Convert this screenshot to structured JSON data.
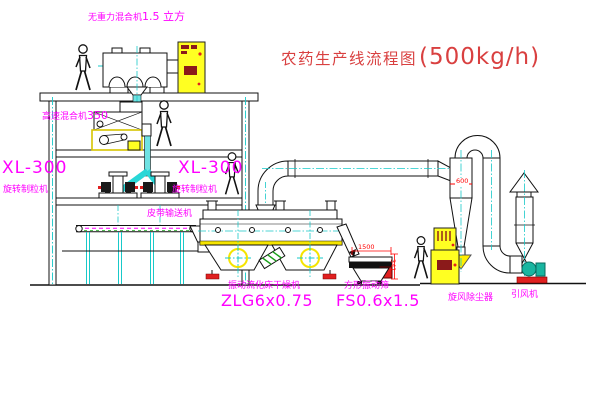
{
  "title": {
    "text": "农药生产线流程图",
    "capacity": "(500kg/h)"
  },
  "labels": {
    "gravity_mixer": {
      "name": "无重力混合机",
      "spec": "1.5 立方"
    },
    "high_speed_mixer": {
      "name": "高速混合机",
      "model": "350"
    },
    "granulator_left": {
      "model": "XL-300",
      "name": "旋转制粒机"
    },
    "granulator_mid": {
      "model": "XL-300",
      "name": "旋转制粒机"
    },
    "belt_conveyor": "皮带输送机",
    "fluid_bed_dryer": {
      "name": "振动流化床干燥机",
      "model": "ZLG6x0.75"
    },
    "vibrating_screen": {
      "name": "方形振动筛",
      "model": "FS0.6x1.5"
    },
    "cyclone": "旋风除尘器",
    "fan": "引风机"
  },
  "dimensions": {
    "screen_length": "1500",
    "screen_height": "341",
    "cyclone_diameter": "600"
  },
  "colors": {
    "label": "#ff00ff",
    "title": "#d94040",
    "dimension": "#ff0000",
    "centerline": "#17c9c9",
    "cabinet": "#ffff22",
    "fan_body": "#19b5a0",
    "base_red": "#e02020"
  }
}
